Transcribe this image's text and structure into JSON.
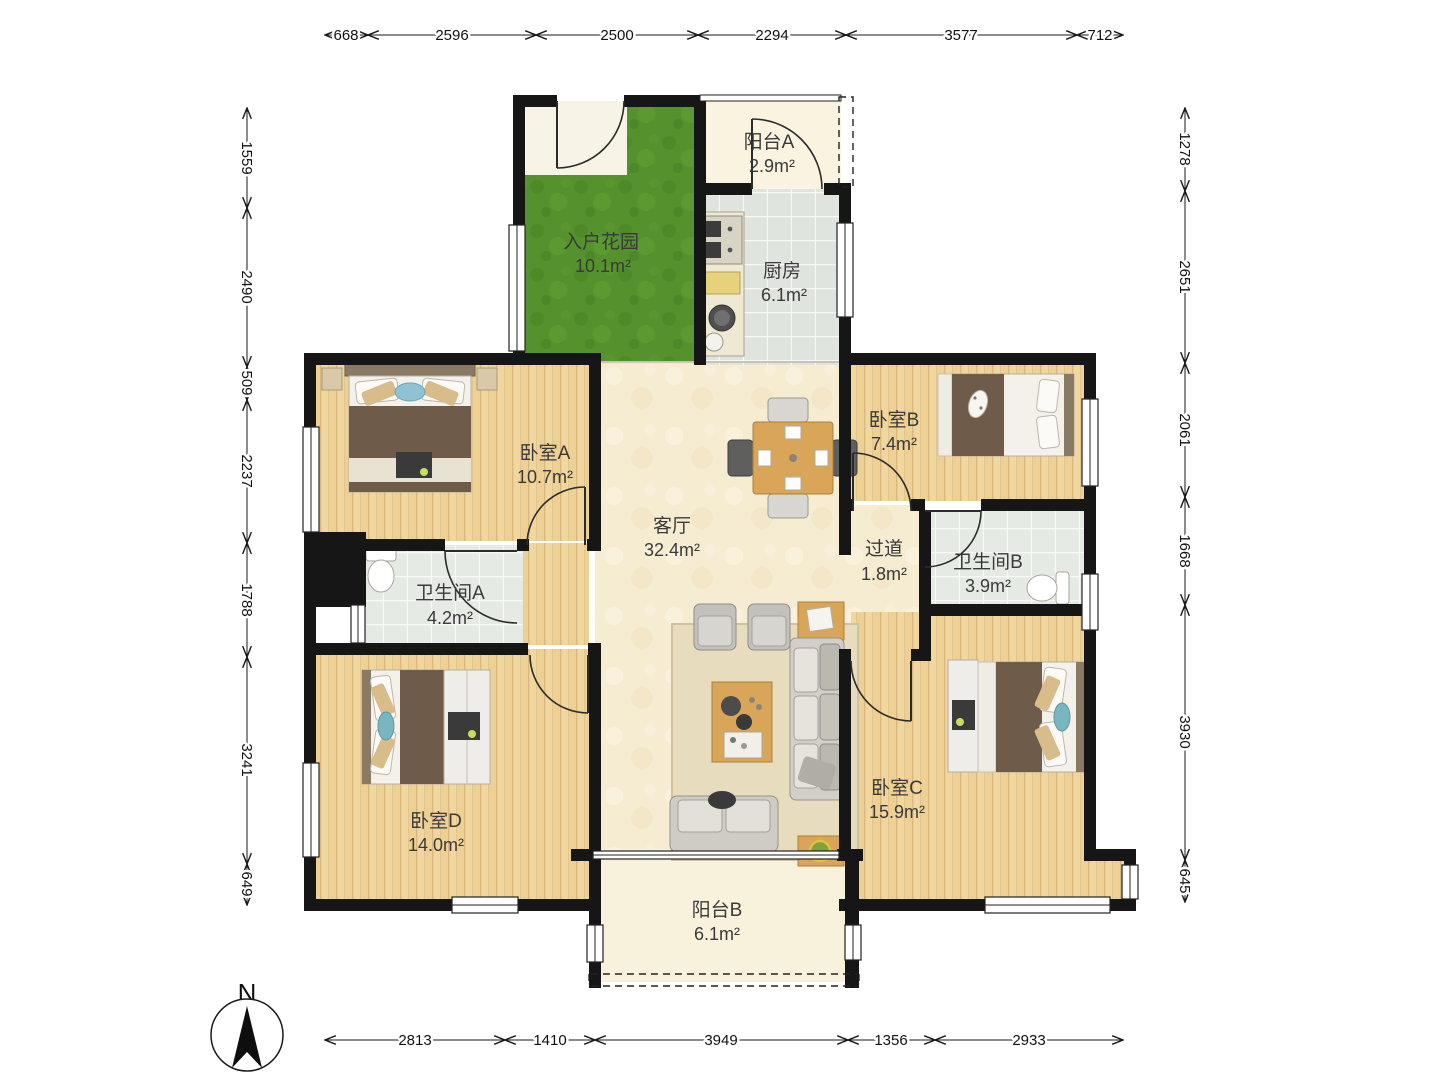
{
  "compass": {
    "north_label": "N"
  },
  "rooms": [
    {
      "id": "balcony-a",
      "name": "阳台A",
      "area": "2.9m²"
    },
    {
      "id": "entry-garden",
      "name": "入户花园",
      "area": "10.1m²"
    },
    {
      "id": "kitchen",
      "name": "厨房",
      "area": "6.1m²"
    },
    {
      "id": "bedroom-a",
      "name": "卧室A",
      "area": "10.7m²"
    },
    {
      "id": "bedroom-b",
      "name": "卧室B",
      "area": "7.4m²"
    },
    {
      "id": "living-room",
      "name": "客厅",
      "area": "32.4m²"
    },
    {
      "id": "hallway",
      "name": "过道",
      "area": "1.8m²"
    },
    {
      "id": "bathroom-a",
      "name": "卫生间A",
      "area": "4.2m²"
    },
    {
      "id": "bathroom-b",
      "name": "卫生间B",
      "area": "3.9m²"
    },
    {
      "id": "bedroom-c",
      "name": "卧室C",
      "area": "15.9m²"
    },
    {
      "id": "bedroom-d",
      "name": "卧室D",
      "area": "14.0m²"
    },
    {
      "id": "balcony-b",
      "name": "阳台B",
      "area": "6.1m²"
    }
  ],
  "dimensions": {
    "top": [
      "668",
      "2596",
      "2500",
      "2294",
      "3577",
      "712"
    ],
    "left": [
      "1559",
      "2490",
      "509",
      "2237",
      "1788",
      "3241",
      "649"
    ],
    "right": [
      "1278",
      "2651",
      "2061",
      "1668",
      "3930",
      "645"
    ],
    "bottom": [
      "2813",
      "1410",
      "3949",
      "1356",
      "2933"
    ]
  }
}
